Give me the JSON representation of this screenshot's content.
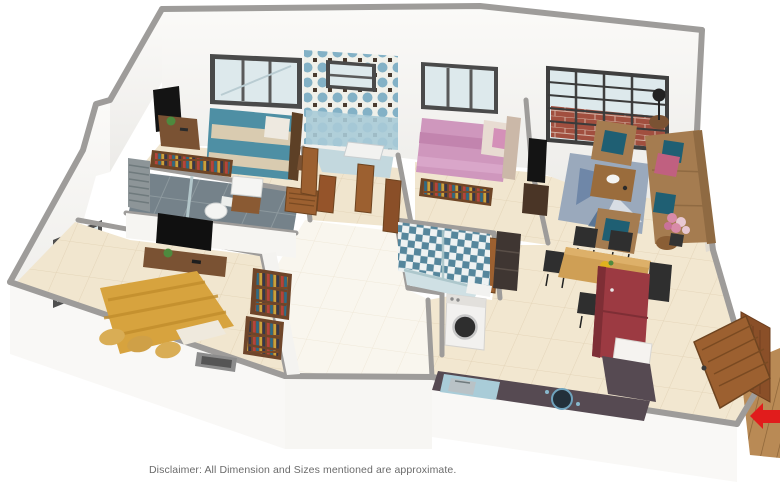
{
  "meta": {
    "type": "3d-isometric-floor-plan-render",
    "background": "#ffffff"
  },
  "disclaimer": {
    "text": "Disclaimer: All Dimension and Sizes mentioned are approximate.",
    "color": "#6b6b6b"
  },
  "palette": {
    "wall_top": "#9e9c9a",
    "wall_face": "#f7f6f3",
    "floor_tile": "#f1e6cf",
    "hall_floor": "#f9f6ee",
    "teal_bed": "#4e8fa4",
    "pink_bed": "#cf97bd",
    "yellow_bed": "#d7a33e",
    "sofa_brown": "#a57c50",
    "rug_blue": "#9aa9bc",
    "dining_wood": "#cf9f55",
    "fridge_red": "#9c3a42",
    "counter_dark": "#564a52",
    "slate_bath": "#75828a",
    "mosaic_blue": "#83b1c6",
    "checker_blue": "#55869c",
    "door_wood": "#9c6030",
    "deck_wood": "#b98a55",
    "brick_red": "#a14f3f",
    "entry_arrow_red": "#e11c1c",
    "glass": "#dde9ec",
    "frame_dark": "#4a4a4a"
  },
  "rooms": [
    {
      "name": "master-bedroom",
      "position": "top-left",
      "furniture": [
        "teal-striped-double-bed",
        "wall-tv",
        "study-desk",
        "potted-plant",
        "open-wardrobe",
        "bedside-table",
        "window"
      ]
    },
    {
      "name": "master-bathroom",
      "position": "left-middle",
      "style": "grey-slate-tiles",
      "furniture": [
        "shower-area",
        "glass-partition",
        "toilet",
        "wash-basin",
        "vanity-cabinet",
        "louver-panel"
      ]
    },
    {
      "name": "bathroom-two",
      "position": "top-middle",
      "style": "blue-mosaic-tiles",
      "furniture": [
        "bathtub",
        "small-window",
        "wooden-doors"
      ]
    },
    {
      "name": "bedroom-two",
      "position": "top-center",
      "style": "pink-bedding",
      "furniture": [
        "pink-double-bed",
        "open-wardrobe",
        "wall-tv",
        "tv-cabinet",
        "window"
      ]
    },
    {
      "name": "living-room",
      "position": "right",
      "furniture": [
        "three-seat-sofa",
        "armchair",
        "armchair",
        "coffee-table",
        "area-rug",
        "table-lamp",
        "side-table",
        "flower-plant",
        "grille-window",
        "brick-wall-outside"
      ]
    },
    {
      "name": "dining-area",
      "position": "center-right",
      "furniture": [
        "dining-table",
        "five-black-chairs",
        "flower-vase",
        "refrigerator",
        "white-cabinet"
      ]
    },
    {
      "name": "kitchen",
      "position": "bottom-right",
      "furniture": [
        "l-shaped-counter",
        "sink",
        "hob",
        "dish-rack"
      ]
    },
    {
      "name": "common-bathroom",
      "position": "center",
      "style": "blue-checker-tiles",
      "furniture": [
        "shower-partition",
        "ledge",
        "dark-cabinet"
      ]
    },
    {
      "name": "utility-area",
      "position": "center-bottom",
      "furniture": [
        "washing-machine"
      ]
    },
    {
      "name": "bedroom-three",
      "position": "bottom-left",
      "style": "yellow-bedding",
      "furniture": [
        "yellow-double-bed",
        "pillows",
        "tv-console",
        "wall-tv",
        "potted-plant",
        "bookshelves",
        "window",
        "door-threshold"
      ]
    },
    {
      "name": "hallway",
      "position": "center",
      "furniture": [
        "wooden-doors",
        "shoe-cabinet"
      ]
    },
    {
      "name": "entrance",
      "position": "bottom-right-corner",
      "furniture": [
        "main-wooden-door",
        "open-door-leaf",
        "wooden-deck",
        "entry-direction-arrow"
      ]
    }
  ]
}
